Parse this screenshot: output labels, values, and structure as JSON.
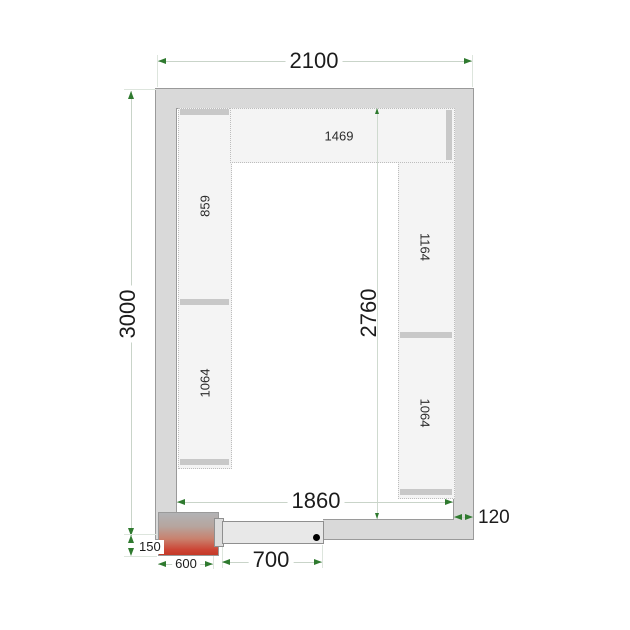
{
  "drawing": {
    "type": "cold-room-floor-plan",
    "dimensions": {
      "outer_width": "2100",
      "outer_height": "3000",
      "inner_height": "2760",
      "inner_width": "1860",
      "wall_thickness": "120",
      "unit_depth": "150",
      "unit_width": "600",
      "door_width": "700"
    },
    "shelves": {
      "top": "1469",
      "left_upper": "859",
      "left_lower": "1064",
      "right_upper": "1164",
      "right_lower": "1064"
    },
    "colors": {
      "wall_fill": "#d9d9d9",
      "wall_border": "#9a9a9a",
      "shelf_fill": "#f4f4f4",
      "shelf_cap": "#c8c8c8",
      "dimension_arrow_green": "#2f7a2f",
      "dimension_line": "#c9d4c9",
      "cooling_unit_red": "#c43927",
      "door_fill": "#e8e8e8",
      "door_handle_dot": "#000000"
    }
  }
}
